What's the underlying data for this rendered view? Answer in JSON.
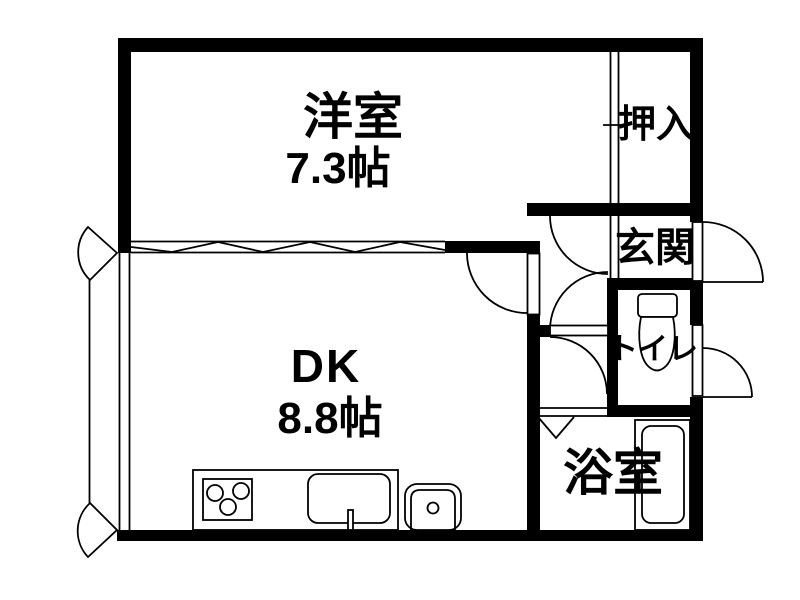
{
  "colors": {
    "wall": "#000000",
    "background": "#ffffff",
    "line": "#000000"
  },
  "rooms": {
    "western": {
      "label": "洋室",
      "size": "7.3帖"
    },
    "dk": {
      "label": "DK",
      "size": "8.8帖"
    },
    "closet": {
      "label": "押入"
    },
    "entrance": {
      "label": "玄関"
    },
    "toilet": {
      "label": "トイレ"
    },
    "bathroom": {
      "label": "浴室"
    }
  }
}
